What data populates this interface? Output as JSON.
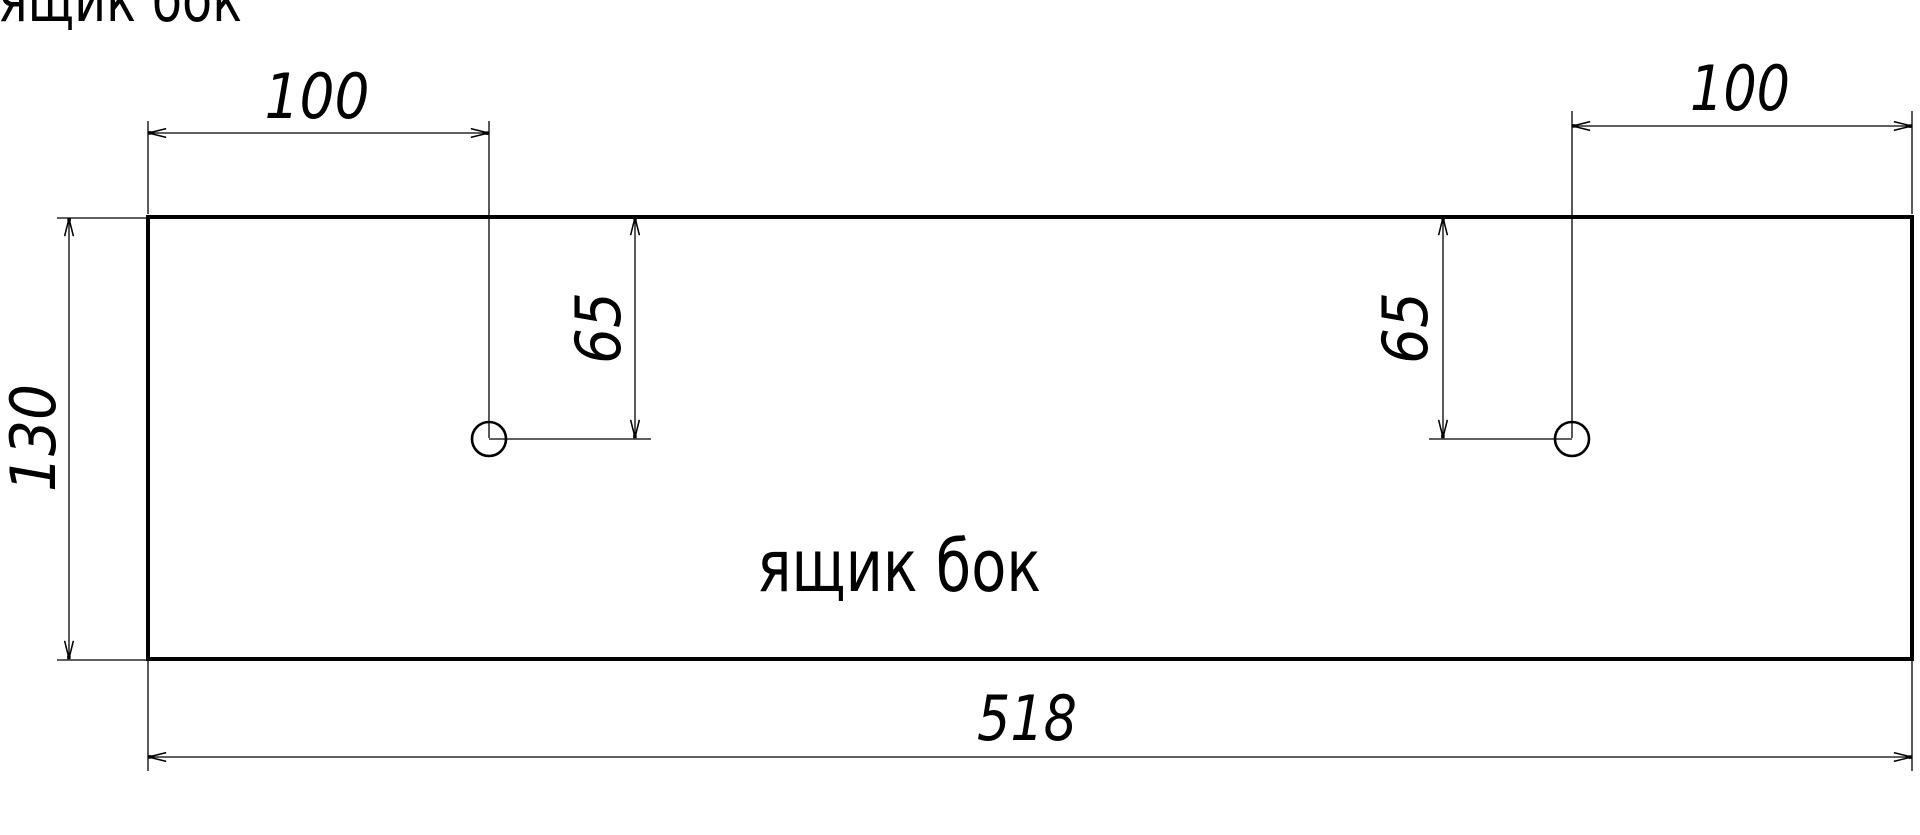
{
  "drawing": {
    "title": "ящик бок",
    "part_label": "ящик бок",
    "dims": {
      "top_left_offset": "100",
      "top_right_offset": "100",
      "left_hole_drop": "65",
      "right_hole_drop": "65",
      "side_height": "130",
      "total_width": "518"
    },
    "colors": {
      "line": "#000000",
      "background": "#ffffff"
    }
  }
}
